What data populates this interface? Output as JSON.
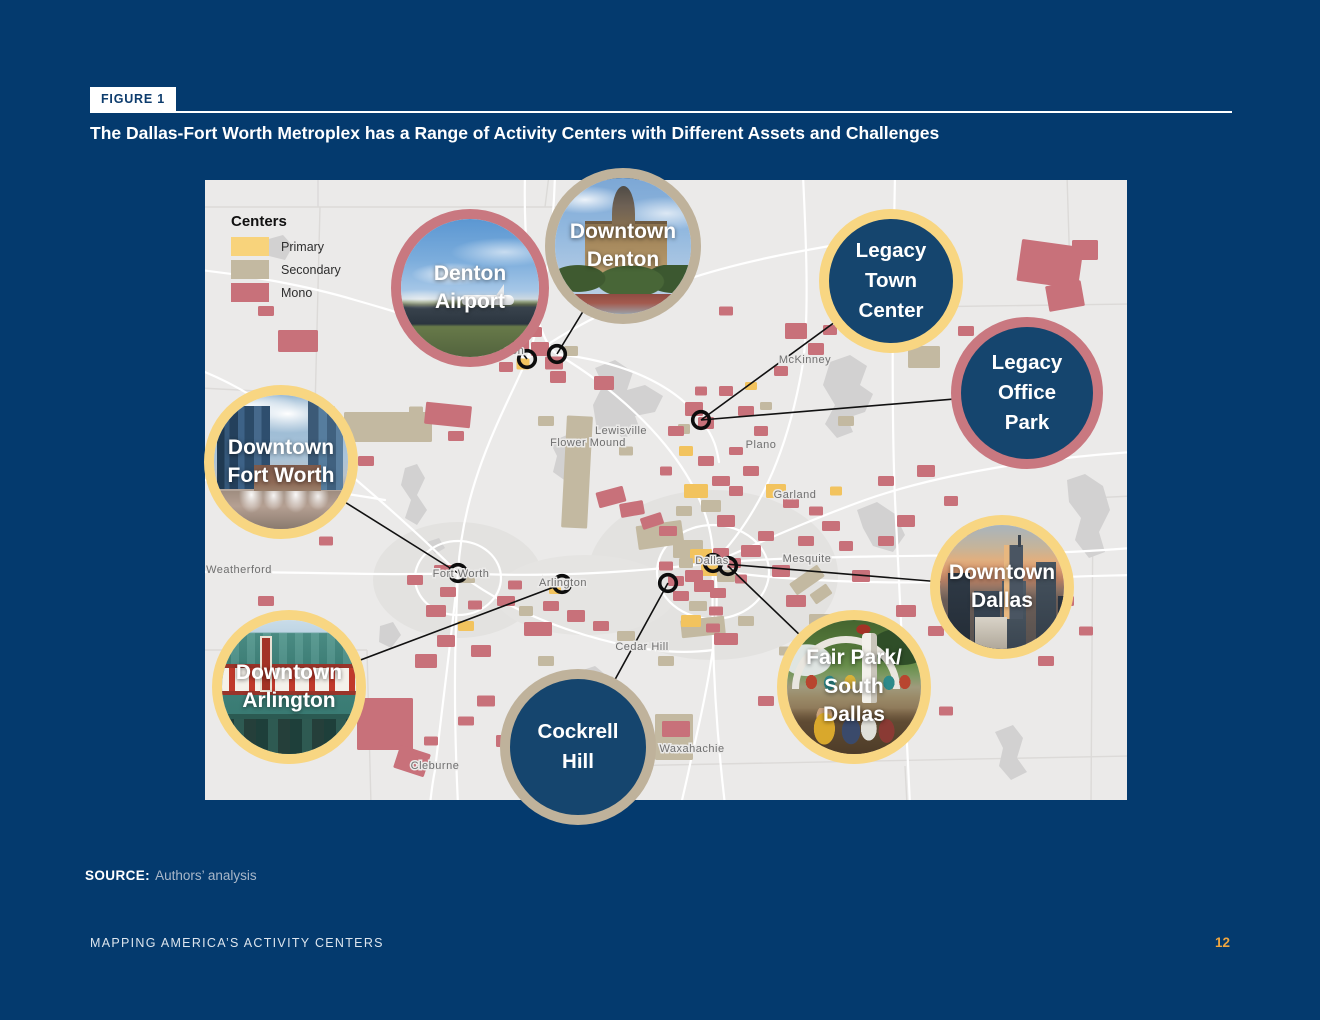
{
  "figure": {
    "tag": "FIGURE 1",
    "title": "The Dallas-Fort Worth Metroplex has a Range of Activity Centers with Different Assets and Challenges"
  },
  "legend": {
    "title": "Centers",
    "items": [
      {
        "label": "Primary",
        "color": "#F8D37B"
      },
      {
        "label": "Secondary",
        "color": "#C3B9A1"
      },
      {
        "label": "Mono",
        "color": "#C8717A"
      }
    ]
  },
  "map": {
    "cities": [
      {
        "name": "Denton",
        "x": 300,
        "y": 174
      },
      {
        "name": "McKinney",
        "x": 600,
        "y": 183
      },
      {
        "name": "Lewisville",
        "x": 416,
        "y": 254
      },
      {
        "name": "Flower Mound",
        "x": 383,
        "y": 266
      },
      {
        "name": "Plano",
        "x": 556,
        "y": 268
      },
      {
        "name": "Garland",
        "x": 590,
        "y": 318
      },
      {
        "name": "Weatherford",
        "x": 34,
        "y": 393
      },
      {
        "name": "Fort Worth",
        "x": 256,
        "y": 397
      },
      {
        "name": "Arlington",
        "x": 358,
        "y": 406
      },
      {
        "name": "Dallas",
        "x": 507,
        "y": 384
      },
      {
        "name": "Mesquite",
        "x": 602,
        "y": 382
      },
      {
        "name": "Cedar Hill",
        "x": 437,
        "y": 470
      },
      {
        "name": "Waxahachie",
        "x": 487,
        "y": 572
      },
      {
        "name": "Cleburne",
        "x": 230,
        "y": 589
      }
    ],
    "callouts": [
      {
        "id": "denton-airport",
        "label": "Denton\nAirport",
        "style": "photo",
        "border": "mono",
        "cx": 265,
        "cy": 108,
        "r": 79,
        "mx": 322,
        "my": 179
      },
      {
        "id": "downtown-denton",
        "label": "Downtown\nDenton",
        "style": "photo",
        "border": "secondary",
        "cx": 418,
        "cy": 66,
        "r": 78,
        "mx": 352,
        "my": 174
      },
      {
        "id": "legacy-town-center",
        "label": "Legacy\nTown\nCenter",
        "style": "solid",
        "border": "primary",
        "cx": 686,
        "cy": 101,
        "r": 72,
        "mx": 496,
        "my": 240
      },
      {
        "id": "legacy-office-park",
        "label": "Legacy\nOffice\nPark",
        "style": "solid",
        "border": "mono",
        "cx": 822,
        "cy": 213,
        "r": 76,
        "mx": 496,
        "my": 240
      },
      {
        "id": "downtown-fort-worth",
        "label": "Downtown\nFort Worth",
        "style": "photo",
        "border": "primary",
        "cx": 76,
        "cy": 282,
        "r": 77,
        "mx": 253,
        "my": 393
      },
      {
        "id": "downtown-arlington",
        "label": "Downtown\nArlington",
        "style": "photo",
        "border": "primary",
        "cx": 84,
        "cy": 507,
        "r": 77,
        "mx": 357,
        "my": 404
      },
      {
        "id": "cockrell-hill",
        "label": "Cockrell\nHill",
        "style": "solid",
        "border": "secondary",
        "cx": 373,
        "cy": 567,
        "r": 78,
        "mx": 463,
        "my": 403
      },
      {
        "id": "fair-park",
        "label": "Fair Park/\nSouth\nDallas",
        "style": "photo",
        "border": "primary",
        "cx": 649,
        "cy": 507,
        "r": 77,
        "mx": 523,
        "my": 386
      },
      {
        "id": "downtown-dallas",
        "label": "Downtown\nDallas",
        "style": "photo",
        "border": "primary",
        "cx": 797,
        "cy": 407,
        "r": 72,
        "mx": 508,
        "my": 383
      }
    ]
  },
  "source": {
    "label": "SOURCE:",
    "text": "Authors’ analysis"
  },
  "footer": {
    "text": "MAPPING AMERICA’S ACTIVITY CENTERS",
    "page": "12"
  },
  "colors": {
    "page_bg": "#043A6E",
    "map_bg": "#EBEAE9",
    "primary": "#F8D37B",
    "secondary": "#C3B9A1",
    "mono": "#C8717A",
    "solid_circle_fill": "#15456E",
    "page_number": "#EFA53F"
  }
}
